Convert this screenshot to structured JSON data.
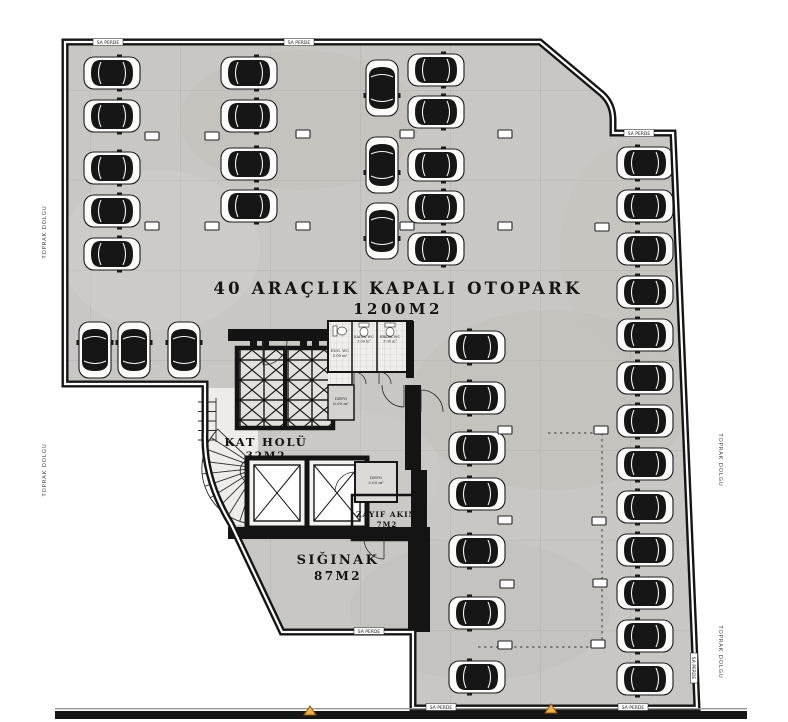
{
  "title": {
    "line1": "40 ARAÇLIK KAPALI OTOPARK",
    "line2": "1200M2"
  },
  "rooms": {
    "kat_holu": {
      "name": "KAT HOLÜ",
      "area": "32M2"
    },
    "siginak": {
      "name": "SIĞINAK",
      "area": "87M2"
    },
    "zayif_akim": {
      "name": "ZAYIF AKIM",
      "area": "7M2"
    },
    "eng_wc": {
      "name": "ENG. WC",
      "area": "5.00 m²"
    },
    "kadin_wc": {
      "name": "KADIN WC",
      "area": "3.00 m²"
    },
    "erkek_wc": {
      "name": "ERKEK WC",
      "area": "3.00 m²"
    },
    "depo": {
      "name": "DEPO",
      "area": "6.00 m²"
    },
    "depo_kucuk": {
      "name": "DEPO",
      "area": "3.00 m²"
    }
  },
  "annotations": {
    "toprak_dolgu": "TOPRAK DOLGU",
    "sa_perde": "SA PERDE"
  },
  "capacity": {
    "cars_total": 40
  },
  "colors": {
    "floor": "#c9c7c3",
    "tile_line": "#b7b5b0",
    "wall": "#151515",
    "paper": "#ffffff",
    "marker_orange": "#efb24a",
    "car_body": "#161616"
  },
  "cars": [
    [
      112,
      73,
      90
    ],
    [
      112,
      116,
      90
    ],
    [
      112,
      168,
      90
    ],
    [
      112,
      211,
      90
    ],
    [
      112,
      254,
      90
    ],
    [
      249,
      73,
      90
    ],
    [
      249,
      116,
      90
    ],
    [
      249,
      164,
      90
    ],
    [
      249,
      206,
      90
    ],
    [
      382,
      88,
      180
    ],
    [
      382,
      165,
      180
    ],
    [
      382,
      231,
      180
    ],
    [
      436,
      70,
      90
    ],
    [
      436,
      112,
      90
    ],
    [
      436,
      165,
      90
    ],
    [
      436,
      207,
      90
    ],
    [
      436,
      249,
      90
    ],
    [
      95,
      350,
      0
    ],
    [
      134,
      350,
      0
    ],
    [
      184,
      350,
      0
    ],
    [
      477,
      347,
      -90
    ],
    [
      477,
      398,
      -90
    ],
    [
      477,
      448,
      -90
    ],
    [
      477,
      494,
      -90
    ],
    [
      477,
      551,
      -90
    ],
    [
      477,
      613,
      -90
    ],
    [
      477,
      677,
      -90
    ],
    [
      645,
      163,
      -90
    ],
    [
      645,
      206,
      -90
    ],
    [
      645,
      249,
      -90
    ],
    [
      645,
      292,
      -90
    ],
    [
      645,
      335,
      -90
    ],
    [
      645,
      378,
      -90
    ],
    [
      645,
      421,
      -90
    ],
    [
      645,
      464,
      -90
    ],
    [
      645,
      507,
      -90
    ],
    [
      645,
      550,
      -90
    ],
    [
      645,
      593,
      -90
    ],
    [
      645,
      636,
      -90
    ],
    [
      645,
      679,
      -90
    ]
  ],
  "column_stubs": [
    [
      152,
      136
    ],
    [
      212,
      136
    ],
    [
      303,
      134
    ],
    [
      407,
      134
    ],
    [
      505,
      134
    ],
    [
      152,
      226
    ],
    [
      212,
      226
    ],
    [
      303,
      226
    ],
    [
      407,
      226
    ],
    [
      505,
      226
    ],
    [
      602,
      227
    ],
    [
      505,
      430
    ],
    [
      601,
      430
    ],
    [
      505,
      520
    ],
    [
      599,
      521
    ],
    [
      507,
      584
    ],
    [
      600,
      583
    ],
    [
      505,
      645
    ],
    [
      598,
      644
    ]
  ],
  "section_markers": [
    [
      310,
      715
    ],
    [
      551,
      713
    ]
  ]
}
